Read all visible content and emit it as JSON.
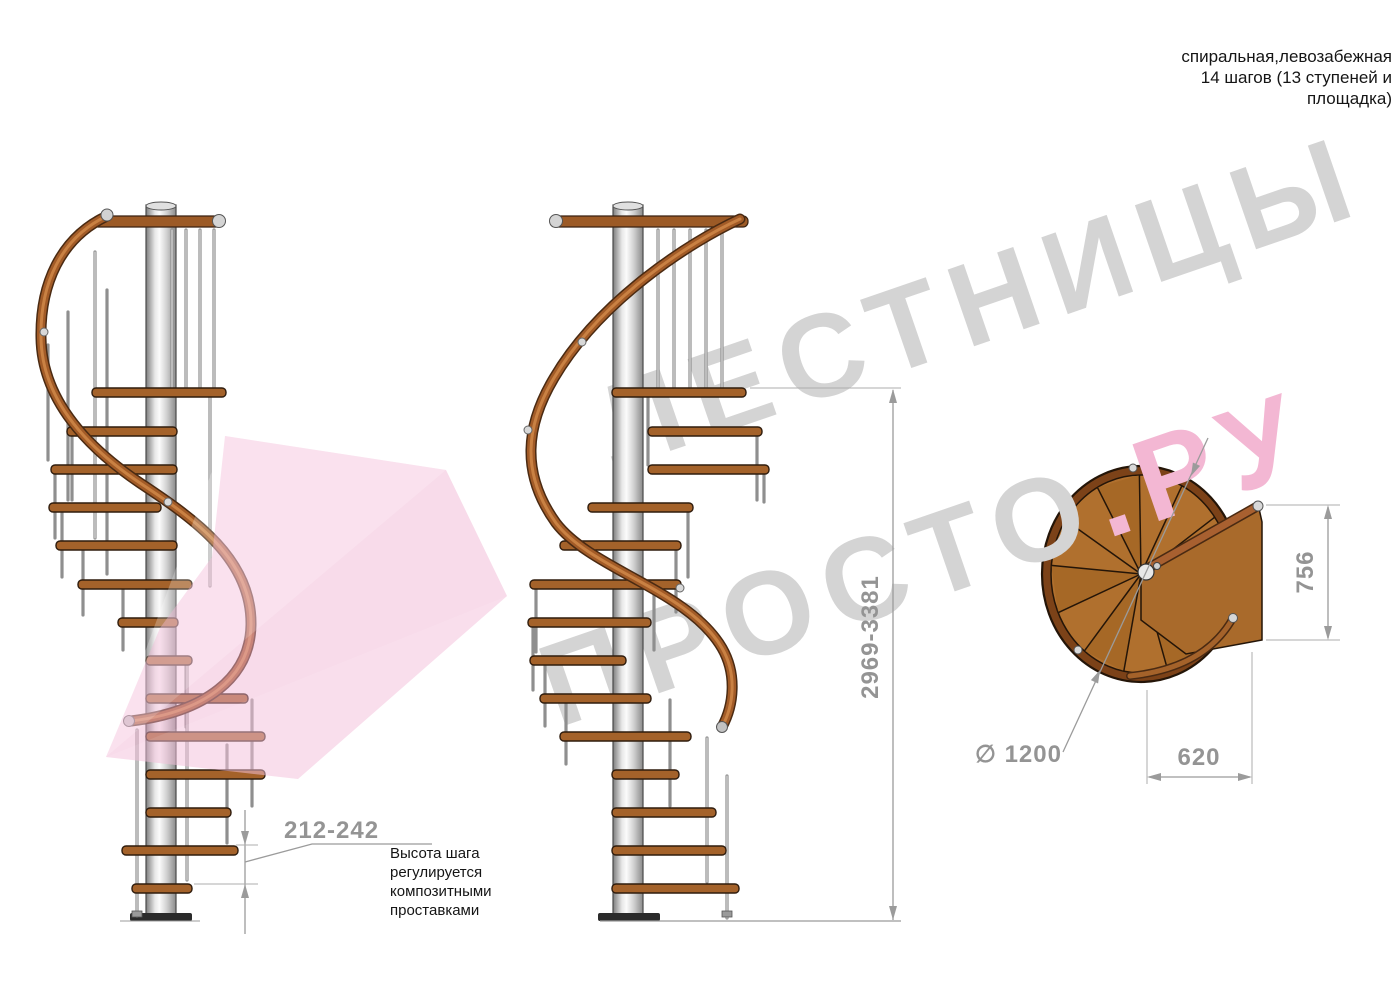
{
  "title": {
    "text": "спиральная,левозабежная\n14 шагов (13 ступеней и\nплощадка)"
  },
  "watermark": {
    "line1": "ЛЕСТНИЦЫ",
    "line2_gray": "ПРОСТО",
    "line2_pink": ".РУ",
    "gray_color": "#d4d4d4",
    "pink_color": "#f3b7d3"
  },
  "dimensions": {
    "total_height": "2969-3381",
    "step_height": "212-242",
    "landing_depth": "756",
    "landing_width": "620",
    "diameter": "∅ 1200"
  },
  "annotations": {
    "step_height_note": "Высота шага\nрегулируется\nкомпозитными\nпроставками"
  },
  "colors": {
    "wood": "#a4622a",
    "wood_dark": "#7c4218",
    "metal": "#d9d9d9",
    "dimension_gray": "#949494",
    "watermark_pink": "#f0a9cd"
  }
}
